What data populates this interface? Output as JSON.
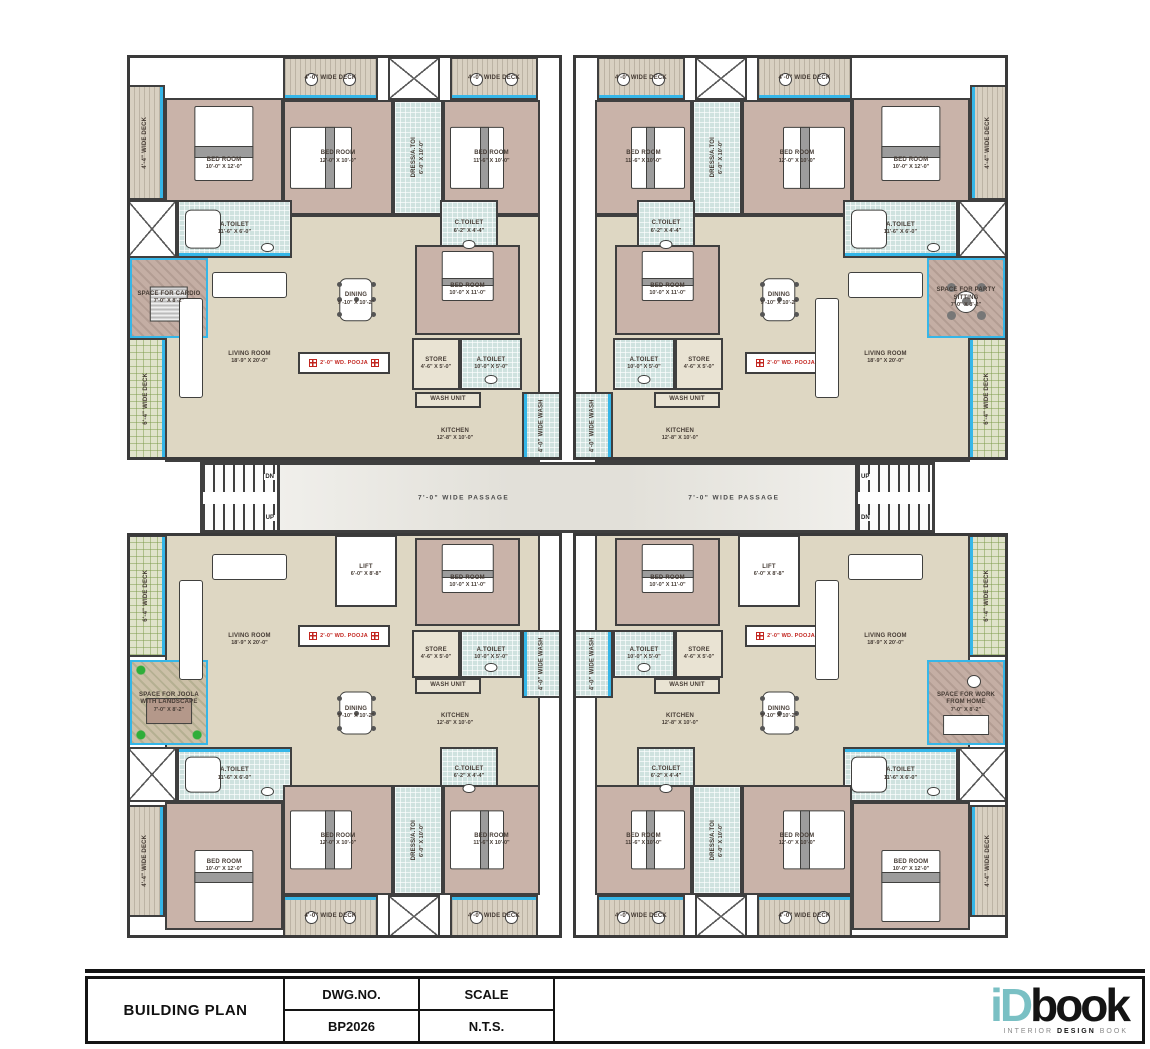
{
  "sheet": {
    "title": "BUILDING PLAN",
    "dwg_no_label": "DWG.NO.",
    "dwg_no": "BP2026",
    "scale_label": "SCALE",
    "scale": "N.T.S.",
    "logo_teal": "iD",
    "logo_dark": "book",
    "tagline_a": "INTERIOR",
    "tagline_b": "DESIGN",
    "tagline_c": "BOOK"
  },
  "colors": {
    "wall": "#3f3f3f",
    "bedroom_fill": "#c9b3a9",
    "hall_fill": "#ded7c3",
    "toilet_fill": "#cfe2df",
    "deck_tan": "#d8d0c1",
    "deck_green": "#e0e3ca",
    "window_cyan": "#35b6e8",
    "pooja_red": "#c2251f",
    "plant_green": "#2fae3a",
    "logo_teal": "#7ac0c4"
  },
  "plan": {
    "passage_label": "7'-0\" WIDE PASSAGE",
    "up_label": "UP",
    "dn_label": "DN",
    "mirror_axis_x": 1135,
    "outlines": [
      {
        "x": 127,
        "y": 55,
        "w": 435,
        "h": 405
      },
      {
        "x": 573,
        "y": 55,
        "w": 435,
        "h": 405
      },
      {
        "x": 127,
        "y": 533,
        "w": 435,
        "h": 405
      },
      {
        "x": 573,
        "y": 533,
        "w": 435,
        "h": 405
      }
    ],
    "center": [
      {
        "id": "passage",
        "cls": "passage",
        "x": 280,
        "y": 462,
        "w": 575,
        "h": 71,
        "labels_at": [
          "24%",
          "71%"
        ]
      },
      {
        "id": "stairs-left",
        "cls": "stairs sl",
        "x": 200,
        "y": 462,
        "w": 80,
        "h": 71,
        "top": "DN",
        "bottom": "UP"
      },
      {
        "id": "stairs-right",
        "cls": "stairs sr",
        "x": 855,
        "y": 462,
        "w": 80,
        "h": 71,
        "top": "UP",
        "bottom": "DN"
      }
    ],
    "quadrant_tl": [
      {
        "id": "tl-interior",
        "cls": "hall",
        "x": 165,
        "y": 215,
        "w": 375,
        "h": 247
      },
      {
        "id": "tl-deck-a",
        "cls": "deck-tan",
        "x": 283,
        "y": 57,
        "w": 95,
        "h": 43,
        "label": "4'-0\" WIDE DECK",
        "win": "b"
      },
      {
        "id": "tl-duct-a",
        "cls": "duct",
        "x": 388,
        "y": 57,
        "w": 52,
        "h": 43
      },
      {
        "id": "tl-deck-b",
        "cls": "deck-tan",
        "x": 450,
        "y": 57,
        "w": 88,
        "h": 43,
        "label": "4'-0\" WIDE DECK",
        "win": "b"
      },
      {
        "id": "tl-deck-left",
        "cls": "deck-tan",
        "x": 127,
        "y": 85,
        "w": 38,
        "h": 115,
        "label": "4'-4\" WIDE DECK",
        "vert": true,
        "win": "r"
      },
      {
        "id": "tl-bed1",
        "cls": "bedroom",
        "x": 165,
        "y": 98,
        "w": 118,
        "h": 132,
        "label": "BED ROOM",
        "dim": "10'-0\" X 12'-0\"",
        "furn": "bed-n"
      },
      {
        "id": "tl-bed2",
        "cls": "bedroom",
        "x": 283,
        "y": 100,
        "w": 110,
        "h": 115,
        "label": "BED ROOM",
        "dim": "12'-0\" X 10'-0\"",
        "furn": "bed-w"
      },
      {
        "id": "tl-dress",
        "cls": "toilet",
        "x": 393,
        "y": 100,
        "w": 50,
        "h": 115,
        "label": "DRESS/A.TOI",
        "dim": "6'-0\" X 10'-0\"",
        "vert": true
      },
      {
        "id": "tl-bed3",
        "cls": "bedroom",
        "x": 443,
        "y": 100,
        "w": 97,
        "h": 115,
        "label": "BED ROOM",
        "dim": "11'-6\" X 10'-0\"",
        "furn": "bed-w"
      },
      {
        "id": "tl-duct-b",
        "cls": "duct",
        "x": 127,
        "y": 200,
        "w": 50,
        "h": 58
      },
      {
        "id": "tl-atoilet1",
        "cls": "toilet",
        "x": 177,
        "y": 200,
        "w": 115,
        "h": 58,
        "label": "A.TOILET",
        "dim": "11'-6\" X 6'-0\"",
        "furn": "tub",
        "win": "b"
      },
      {
        "id": "tl-ctoilet",
        "cls": "toilet",
        "x": 440,
        "y": 200,
        "w": 58,
        "h": 55,
        "label": "C.TOILET",
        "dim": "6'-2\" X 4'-4\"",
        "furn": "wc"
      },
      {
        "id": "tl-corner",
        "cls": "corner",
        "x": 130,
        "y": 258,
        "w": 78,
        "h": 80,
        "label": "SPACE FOR CARDIO",
        "dim": "7'-0\" X 8'-2\"",
        "furn": "treadmill"
      },
      {
        "id": "tl-deck-green",
        "cls": "deck-green",
        "x": 127,
        "y": 338,
        "w": 40,
        "h": 122,
        "label": "6'-4\" WIDE DECK",
        "vert": true,
        "win": "r"
      },
      {
        "id": "tl-living",
        "cls": "open",
        "x": 167,
        "y": 258,
        "w": 165,
        "h": 200,
        "label": "LIVING ROOM",
        "dim": "18'-9\" X 20'-0\"",
        "furn": "sofa"
      },
      {
        "id": "tl-dining",
        "cls": "open",
        "x": 312,
        "y": 262,
        "w": 88,
        "h": 75,
        "label": "DINING",
        "dim": "9'-10\" X 10'-2\"",
        "furn": "dining"
      },
      {
        "id": "tl-pooja",
        "cls": "pooja",
        "x": 298,
        "y": 352,
        "w": 92,
        "h": 22,
        "label": "2'-0\" WD. POOJA"
      },
      {
        "id": "tl-bed4",
        "cls": "bedroom",
        "x": 415,
        "y": 245,
        "w": 105,
        "h": 90,
        "label": "BED ROOM",
        "dim": "10'-0\" X 11'-0\"",
        "furn": "bed-n"
      },
      {
        "id": "tl-store",
        "cls": "store",
        "x": 412,
        "y": 338,
        "w": 48,
        "h": 52,
        "label": "STORE",
        "dim": "4'-6\" X 5'-0\""
      },
      {
        "id": "tl-atoilet2",
        "cls": "toilet",
        "x": 460,
        "y": 338,
        "w": 62,
        "h": 52,
        "label": "A.TOILET",
        "dim": "10'-0\" X 5'-0\"",
        "furn": "wc"
      },
      {
        "id": "tl-washunit",
        "cls": "store",
        "x": 415,
        "y": 392,
        "w": 66,
        "h": 16,
        "label": "WASH UNIT"
      },
      {
        "id": "tl-kitchen",
        "cls": "open",
        "x": 390,
        "y": 410,
        "w": 130,
        "h": 50,
        "label": "KITCHEN",
        "dim": "12'-8\" X 10'-0\""
      },
      {
        "id": "tl-wash",
        "cls": "toilet",
        "x": 522,
        "y": 392,
        "w": 40,
        "h": 68,
        "label": "4'-0\" WIDE WASH",
        "vert": true,
        "win": "l"
      }
    ],
    "quadrant_bl": [
      {
        "id": "bl-interior",
        "cls": "hall",
        "x": 165,
        "y": 533,
        "w": 375,
        "h": 257
      },
      {
        "id": "bl-lift",
        "cls": "lift",
        "x": 335,
        "y": 535,
        "w": 62,
        "h": 72,
        "label": "LIFT",
        "dim": "6'-0\" X 8'-8\""
      },
      {
        "id": "bl-bed4",
        "cls": "bedroom",
        "x": 415,
        "y": 538,
        "w": 105,
        "h": 88,
        "label": "BED ROOM",
        "dim": "10'-0\" X 11'-0\"",
        "furn": "bed-n"
      },
      {
        "id": "bl-living",
        "cls": "open",
        "x": 167,
        "y": 540,
        "w": 165,
        "h": 200,
        "label": "LIVING ROOM",
        "dim": "18'-9\" X 20'-0\"",
        "furn": "sofa"
      },
      {
        "id": "bl-pooja",
        "cls": "pooja",
        "x": 298,
        "y": 625,
        "w": 92,
        "h": 22,
        "label": "2'-0\" WD. POOJA"
      },
      {
        "id": "bl-store",
        "cls": "store",
        "x": 412,
        "y": 630,
        "w": 48,
        "h": 48,
        "label": "STORE",
        "dim": "4'-6\" X 5'-0\""
      },
      {
        "id": "bl-atoilet2",
        "cls": "toilet",
        "x": 460,
        "y": 630,
        "w": 62,
        "h": 48,
        "label": "A.TOILET",
        "dim": "10'-0\" X 5'-0\"",
        "furn": "wc"
      },
      {
        "id": "bl-washunit",
        "cls": "store",
        "x": 415,
        "y": 678,
        "w": 66,
        "h": 16,
        "label": "WASH UNIT"
      },
      {
        "id": "bl-kitchen",
        "cls": "open",
        "x": 390,
        "y": 694,
        "w": 130,
        "h": 52,
        "label": "KITCHEN",
        "dim": "12'-8\" X 10'-0\""
      },
      {
        "id": "bl-wash",
        "cls": "toilet",
        "x": 522,
        "y": 630,
        "w": 40,
        "h": 68,
        "label": "4'-0\" WIDE WASH",
        "vert": true,
        "win": "l"
      },
      {
        "id": "bl-dining",
        "cls": "open",
        "x": 312,
        "y": 676,
        "w": 88,
        "h": 74,
        "label": "DINING",
        "dim": "9'-10\" X 10'-2\"",
        "furn": "dining"
      },
      {
        "id": "bl-corner",
        "cls": "corner-green",
        "x": 130,
        "y": 660,
        "w": 78,
        "h": 85,
        "label": "SPACE FOR JOOLA WITH LANDSCAPE",
        "dim": "7'-0\" X 8'-2\"",
        "furn": "swing"
      },
      {
        "id": "bl-deck-green",
        "cls": "deck-green",
        "x": 127,
        "y": 535,
        "w": 40,
        "h": 122,
        "label": "6'-4\" WIDE DECK",
        "vert": true,
        "win": "r"
      },
      {
        "id": "bl-duct-b",
        "cls": "duct",
        "x": 127,
        "y": 747,
        "w": 50,
        "h": 55
      },
      {
        "id": "bl-atoilet1",
        "cls": "toilet",
        "x": 177,
        "y": 747,
        "w": 115,
        "h": 55,
        "label": "A.TOILET",
        "dim": "11'-6\" X 6'-0\"",
        "furn": "tub",
        "win": "t"
      },
      {
        "id": "bl-ctoilet",
        "cls": "toilet",
        "x": 440,
        "y": 747,
        "w": 58,
        "h": 52,
        "label": "C.TOILET",
        "dim": "6'-2\" X 4'-4\"",
        "furn": "wc"
      },
      {
        "id": "bl-deck-left",
        "cls": "deck-tan",
        "x": 127,
        "y": 805,
        "w": 38,
        "h": 112,
        "label": "4'-4\" WIDE DECK",
        "vert": true,
        "win": "r"
      },
      {
        "id": "bl-bed1",
        "cls": "bedroom",
        "x": 165,
        "y": 802,
        "w": 118,
        "h": 128,
        "label": "BED ROOM",
        "dim": "10'-0\" X 12'-0\"",
        "furn": "bed-s"
      },
      {
        "id": "bl-bed2",
        "cls": "bedroom",
        "x": 283,
        "y": 785,
        "w": 110,
        "h": 110,
        "label": "BED ROOM",
        "dim": "12'-0\" X 10'-0\"",
        "furn": "bed-w"
      },
      {
        "id": "bl-dress",
        "cls": "toilet",
        "x": 393,
        "y": 785,
        "w": 50,
        "h": 110,
        "label": "DRESS/A.TOI",
        "dim": "6'-0\" X 10'-0\"",
        "vert": true
      },
      {
        "id": "bl-bed3",
        "cls": "bedroom",
        "x": 443,
        "y": 785,
        "w": 97,
        "h": 110,
        "label": "BED ROOM",
        "dim": "11'-6\" X 10'-0\"",
        "furn": "bed-w"
      },
      {
        "id": "bl-deck-a",
        "cls": "deck-tan",
        "x": 283,
        "y": 895,
        "w": 95,
        "h": 43,
        "label": "4'-0\" WIDE DECK",
        "win": "t"
      },
      {
        "id": "bl-duct-a",
        "cls": "duct",
        "x": 388,
        "y": 895,
        "w": 52,
        "h": 43
      },
      {
        "id": "bl-deck-b",
        "cls": "deck-tan",
        "x": 450,
        "y": 895,
        "w": 88,
        "h": 43,
        "label": "4'-0\" WIDE DECK",
        "win": "t"
      }
    ],
    "corner_overrides": {
      "tr-corner": {
        "cls": "corner",
        "label": "SPACE FOR PARTY SITTING",
        "dim": "7'-0\" X 8'-2\"",
        "furn": "round4"
      },
      "br-corner": {
        "cls": "corner",
        "label": "SPACE FOR WORK FROM HOME",
        "dim": "7'-0\" X 8'-2\"",
        "furn": "desk"
      }
    }
  }
}
